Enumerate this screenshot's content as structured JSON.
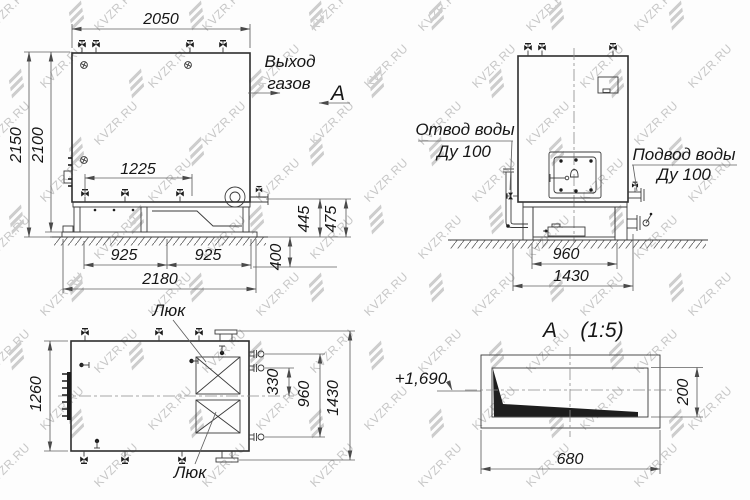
{
  "watermark": {
    "text": "KVZR.RU"
  },
  "colors": {
    "line": "#2e2e2e",
    "dim_line": "#5f5f5f",
    "watermark": "#c7c7c7"
  },
  "front_view": {
    "dim_top_width": "2050",
    "dim_height_overall": "2150",
    "dim_height_body": "2100",
    "dim_nozzle_span": "1225",
    "dim_base_left": "925",
    "dim_base_right": "925",
    "dim_base_overall": "2180",
    "dim_right_inner": "445",
    "dim_right_outer": "475",
    "dim_foundation": "400",
    "label_gas_outlet_1": "Выход",
    "label_gas_outlet_2": "газов",
    "section_letter": "А"
  },
  "side_view": {
    "label_water_outlet": "Отвод воды",
    "label_water_outlet_dn": "Ду 100",
    "label_water_inlet": "Подвод воды",
    "label_water_inlet_dn": "Ду 100",
    "dim_base_width": "960",
    "dim_overall_width": "1430"
  },
  "plan_view": {
    "label_hatch_top": "Люк",
    "label_hatch_bottom": "Люк",
    "dim_width": "1260",
    "dim_pipe_offset": "330",
    "dim_pipe_span": "960",
    "dim_overall": "1430"
  },
  "section_view": {
    "title_letter": "А",
    "title_scale": "(1:5)",
    "elevation": "+1,690",
    "dim_width": "680",
    "dim_height": "200"
  }
}
